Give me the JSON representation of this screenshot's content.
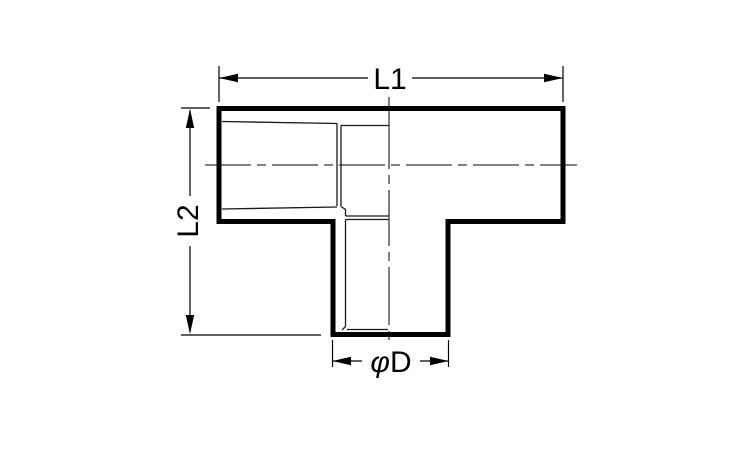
{
  "figure": {
    "kind": "dimensioned outline drawing of a tee pipe fitting, front view"
  },
  "labels": {
    "l1": "L1",
    "l2": "L2",
    "dia_phi": "φ",
    "dia_letter": "D"
  },
  "colors": {
    "line": "#000000",
    "background": "#ffffff"
  }
}
